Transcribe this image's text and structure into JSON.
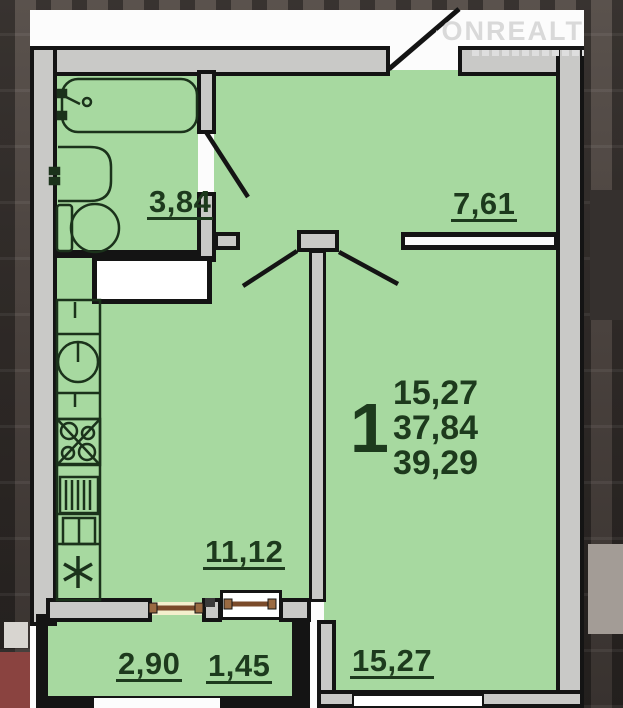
{
  "brand": {
    "name": "ONREALT",
    "icon": "house-icon"
  },
  "floorplan": {
    "rooms": {
      "bathroom": {
        "name": "bathroom",
        "area": "3,84"
      },
      "hallway": {
        "name": "hallway",
        "area": "7,61"
      },
      "kitchen": {
        "name": "kitchen",
        "area": "11,12"
      },
      "living_room": {
        "name": "living-room",
        "area": "15,27"
      },
      "balcony": {
        "name": "balcony",
        "area_full": "2,90",
        "area_reduced": "1,45"
      }
    },
    "summary": {
      "room_count": "1",
      "living_area": "15,27",
      "area_without_balcony": "37,84",
      "total_area": "39,29"
    },
    "fixtures": [
      "bathtub-icon",
      "washbasin-icon",
      "toilet-icon",
      "kitchen-counter-icon",
      "kitchen-sink-icon",
      "stove-icon",
      "fridge-star-icon",
      "balcony-window-icon"
    ],
    "colors": {
      "room_fill": "#a7d9a0",
      "wall_fill": "#c9c9c7",
      "wall_outline": "#141414",
      "label_text": "#1d3a1d",
      "window_frame": "#8a5a36",
      "watermark": "#d9d9d9"
    }
  }
}
